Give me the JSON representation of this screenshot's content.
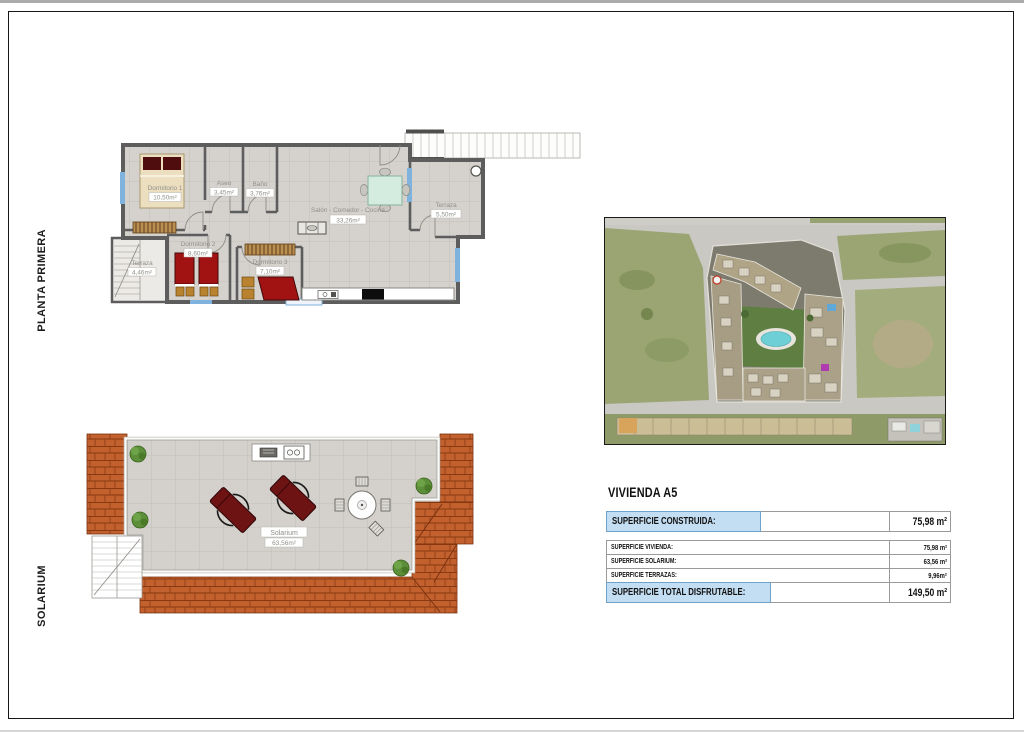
{
  "side_labels": {
    "top": "PLANTA PRIMERA",
    "bottom": "SOLARIUM"
  },
  "floor_plan": {
    "rooms": [
      {
        "name": "Dormitorio 1",
        "area": "10,50m²"
      },
      {
        "name": "Aseo",
        "area": "3,45m²"
      },
      {
        "name": "Baño",
        "area": "3,76m²"
      },
      {
        "name": "Salón - Comedor - Cocina",
        "area": "33,26m²"
      },
      {
        "name": "Terraza",
        "area": "5,50m²"
      },
      {
        "name": "Dormitorio 2",
        "area": "8,60m²"
      },
      {
        "name": "Dormitorio 3",
        "area": "7,10m²"
      },
      {
        "name": "Terraza",
        "area": "4,46m²"
      }
    ]
  },
  "solarium_plan": {
    "name": "Solarium",
    "area": "63,56m²"
  },
  "info_panel": {
    "title": "VIVIENDA A5",
    "rows": [
      {
        "label": "SUPERFICIE CONSTRUIDA:",
        "value": "75,98 m²",
        "highlight": true
      },
      {
        "label": "SUPERFICIE VIVIENDA:",
        "value": "75,98 m²"
      },
      {
        "label": "SUPERFICIE SOLARIUM:",
        "value": "63,56 m²"
      },
      {
        "label": "SUPERFICIE TERRAZAS:",
        "value": "9,96m²"
      },
      {
        "label": "SUPERFICIE TOTAL DISFRUTABLE:",
        "value": "149,50 m²",
        "highlight": true
      }
    ]
  },
  "colors": {
    "highlight_blue": "#c3ddf2",
    "roof_terracotta": "#c2602e",
    "bed_red": "#a11313",
    "window_blue": "#7fb2dc",
    "pool_cyan": "#6fcfd6",
    "floor_gray": "#d5d2cd"
  }
}
